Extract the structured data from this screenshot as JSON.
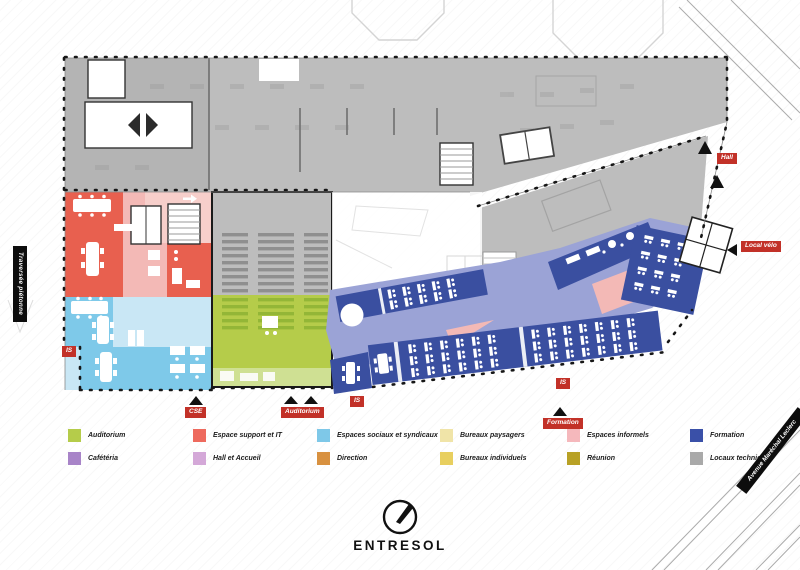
{
  "title": {
    "compass_label": "ENTRESOL"
  },
  "banners": {
    "left": "Traversée piétonne",
    "right": "Avenue Maréchal Leclerc"
  },
  "plan_labels": {
    "hall": "Hall",
    "local_velo": "Local vélo",
    "cse": "CSE",
    "auditorium": "Auditorium",
    "formation": "Formation",
    "is": "IS"
  },
  "legend": {
    "items": [
      {
        "label": "Auditorium",
        "color": "#b5cc4a"
      },
      {
        "label": "Cafétéria",
        "color": "#a884c8"
      },
      {
        "label": "Espace support et IT",
        "color": "#ee6a5e"
      },
      {
        "label": "Hall et Accueil",
        "color": "#d4a8d8"
      },
      {
        "label": "Espaces sociaux et syndicaux",
        "color": "#7ec8e8"
      },
      {
        "label": "Direction",
        "color": "#d89140"
      },
      {
        "label": "Bureaux paysagers",
        "color": "#f0e4a8"
      },
      {
        "label": "Bureaux individuels",
        "color": "#e8cf5f"
      },
      {
        "label": "Espaces informels",
        "color": "#f5b8bc"
      },
      {
        "label": "Réunion",
        "color": "#b8a125"
      },
      {
        "label": "Formation",
        "color": "#3a50a8"
      },
      {
        "label": "Locaux techniques",
        "color": "#a9a9a9"
      }
    ]
  },
  "zone_colors": {
    "gray": "#bdbdbd",
    "gray2": "#b4b4b4",
    "gray_dark": "#8f8f8f",
    "support": "#e8604f",
    "informel": "#f3b9b6",
    "informel_light": "#f7cfcb",
    "sociaux": "#7ec9e9",
    "sociaux_light": "#c9e7f5",
    "auditorium": "#b5cc4a",
    "auditorium_dark": "#93b637",
    "auditorium_light": "#cfe093",
    "formation": "#3a4fa0",
    "corridor": "#9ba3d6",
    "badge": "#c23128"
  }
}
